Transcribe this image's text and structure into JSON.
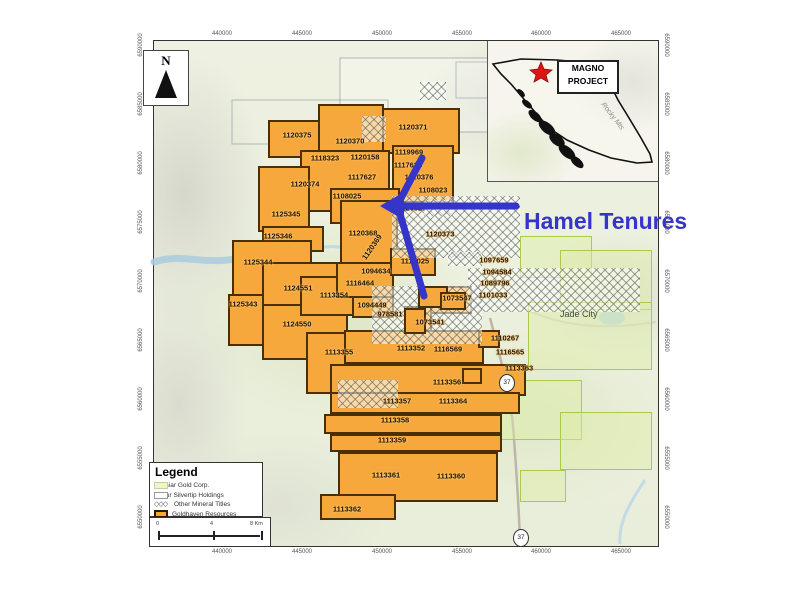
{
  "map": {
    "annotation": "Hamel Tenures",
    "inset_label_line1": "MAGNO",
    "inset_label_line2": "PROJECT",
    "inset_terrain_label": "Rocky Mts",
    "place_label": "Jade City",
    "north_label": "N",
    "highway_shield": "37"
  },
  "axes": {
    "x_ticks": [
      "440000",
      "445000",
      "450000",
      "455000",
      "460000",
      "465000"
    ],
    "y_ticks": [
      "6590000",
      "6585000",
      "6580000",
      "6575000",
      "6570000",
      "6565000",
      "6560000",
      "6555000",
      "6550000"
    ]
  },
  "legend": {
    "title": "Legend",
    "items": [
      {
        "label": "Cassiar Gold Corp.",
        "swatch": "cassiar"
      },
      {
        "label": "Coeur Silvertip Holdings",
        "swatch": "coeur"
      },
      {
        "label": "Other Mineral Titles",
        "swatch": "other"
      },
      {
        "label": "Goldhaven Resources",
        "swatch": "goldhaven"
      }
    ]
  },
  "scalebar": {
    "labels": [
      "0",
      "4",
      "8 Km"
    ]
  },
  "colors": {
    "goldhaven_orange": "#F6A83C",
    "claim_outline": "#4A3000",
    "annotation_blue": "#3535C9",
    "star_red": "#DD1512",
    "cassiar_fill": "#F2F2CC",
    "terrain": "#EDF0E0"
  },
  "tenures": [
    {
      "id": "1120375",
      "x": 297,
      "y": 135
    },
    {
      "id": "1120370",
      "x": 350,
      "y": 141
    },
    {
      "id": "1120371",
      "x": 413,
      "y": 127
    },
    {
      "id": "1118323",
      "x": 325,
      "y": 158
    },
    {
      "id": "1120158",
      "x": 365,
      "y": 157
    },
    {
      "id": "1119969",
      "x": 409,
      "y": 152
    },
    {
      "id": "1117628",
      "x": 408,
      "y": 165
    },
    {
      "id": "1120376",
      "x": 419,
      "y": 177
    },
    {
      "id": "1108023",
      "x": 433,
      "y": 190
    },
    {
      "id": "1117627",
      "x": 362,
      "y": 177
    },
    {
      "id": "1120374",
      "x": 305,
      "y": 184
    },
    {
      "id": "1108025",
      "x": 347,
      "y": 196
    },
    {
      "id": "1125345",
      "x": 286,
      "y": 214
    },
    {
      "id": "1125346",
      "x": 278,
      "y": 236
    },
    {
      "id": "1120368",
      "x": 363,
      "y": 233
    },
    {
      "id": "1120627",
      "x": 412,
      "y": 208
    },
    {
      "id": "1120373",
      "x": 440,
      "y": 234
    },
    {
      "id": "1120369",
      "x": 372,
      "y": 247,
      "rot": -55
    },
    {
      "id": "1125344",
      "x": 258,
      "y": 262
    },
    {
      "id": "1124551",
      "x": 298,
      "y": 288
    },
    {
      "id": "1116464",
      "x": 360,
      "y": 283
    },
    {
      "id": "1094634",
      "x": 376,
      "y": 271
    },
    {
      "id": "1117025",
      "x": 415,
      "y": 261
    },
    {
      "id": "1097659",
      "x": 494,
      "y": 260
    },
    {
      "id": "1094584",
      "x": 497,
      "y": 272
    },
    {
      "id": "1089796",
      "x": 495,
      "y": 283
    },
    {
      "id": "1101033",
      "x": 493,
      "y": 295
    },
    {
      "id": "1113354",
      "x": 334,
      "y": 295
    },
    {
      "id": "1094449",
      "x": 372,
      "y": 305
    },
    {
      "id": "978581",
      "x": 390,
      "y": 314
    },
    {
      "id": "1073547",
      "x": 457,
      "y": 298
    },
    {
      "id": "1073541",
      "x": 430,
      "y": 322
    },
    {
      "id": "1125343",
      "x": 243,
      "y": 304
    },
    {
      "id": "1124550",
      "x": 297,
      "y": 324
    },
    {
      "id": "1113355",
      "x": 339,
      "y": 352
    },
    {
      "id": "1113352",
      "x": 411,
      "y": 348
    },
    {
      "id": "1116569",
      "x": 448,
      "y": 349
    },
    {
      "id": "1110267",
      "x": 505,
      "y": 338
    },
    {
      "id": "1116565",
      "x": 510,
      "y": 352
    },
    {
      "id": "1113363",
      "x": 519,
      "y": 368
    },
    {
      "id": "1113356",
      "x": 447,
      "y": 382
    },
    {
      "id": "1113357",
      "x": 397,
      "y": 401
    },
    {
      "id": "1113364",
      "x": 453,
      "y": 401
    },
    {
      "id": "1113358",
      "x": 395,
      "y": 420
    },
    {
      "id": "1113359",
      "x": 392,
      "y": 440
    },
    {
      "id": "1113361",
      "x": 386,
      "y": 475
    },
    {
      "id": "1113360",
      "x": 451,
      "y": 476
    },
    {
      "id": "1113362",
      "x": 347,
      "y": 509
    }
  ]
}
